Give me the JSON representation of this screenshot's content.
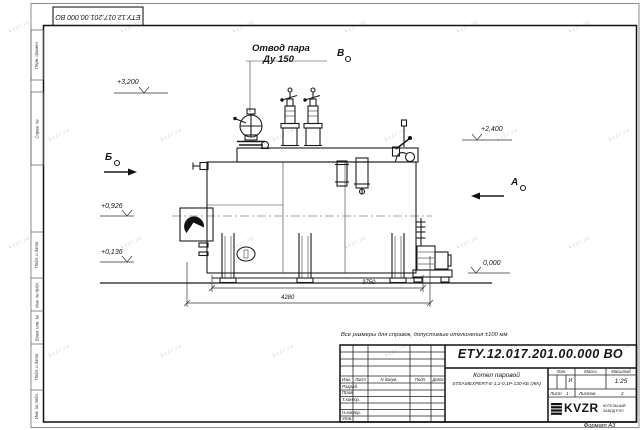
{
  "page": {
    "watermark": "kvzr.ru",
    "format_label": "Формат А3"
  },
  "top_stamp": {
    "doc_number": "ЕТУ.12.017.201.00.000  ВО"
  },
  "margin": {
    "top_labels": [
      "Перв. примен.",
      "Справ. №"
    ],
    "bottom_labels": [
      "Подп. и дата",
      "Инв. № дубл.",
      "Взам. инв. №",
      "Подп. и дата",
      "Инв. № подл."
    ]
  },
  "drawing": {
    "steam_outlet_label": "Отвод пара",
    "steam_outlet_size": "Ду 150",
    "sections": {
      "b": "Б",
      "v": "В",
      "a": "А"
    },
    "elevations": {
      "e1": "+3,200",
      "e2": "+2,400",
      "e3": "+0,926",
      "e4": "+0,136",
      "e5": "0,000"
    },
    "dimensions": {
      "d1": "3750",
      "d2": "4280"
    },
    "note": "Все размеры для справок, допустимые отклонения  ±100 мм"
  },
  "title_block": {
    "doc_number": "ЕТУ.12.017.201.00.000  ВО",
    "name_line1": "Котел паровой",
    "name_line2": "STEAMEXPERT-Е-1,2-0,1Р-130-КБ (ЖК)",
    "col_izm": "Изм.",
    "col_list": "Лист",
    "col_ndoc": "N докум.",
    "col_podp": "Подп.",
    "col_data": "Дата",
    "row_razrab": "Разраб.",
    "row_prov": "Пров.",
    "row_tkontr": "Т.контр.",
    "row_nkontr": "Н.контр.",
    "row_utv": "Утв.",
    "lit_header": "Лит.",
    "mass_header": "Масса",
    "scale_header": "Масштаб",
    "lit_value": "И",
    "scale_value": "1:25",
    "sheet_label": "Лист",
    "sheet_value": "1",
    "sheets_label": "Листов",
    "sheets_value": "2",
    "logo": "KVZR",
    "logo_sub1": "КОТЕЛЬНЫЙ",
    "logo_sub2": "ЗАВОД РЭП"
  }
}
